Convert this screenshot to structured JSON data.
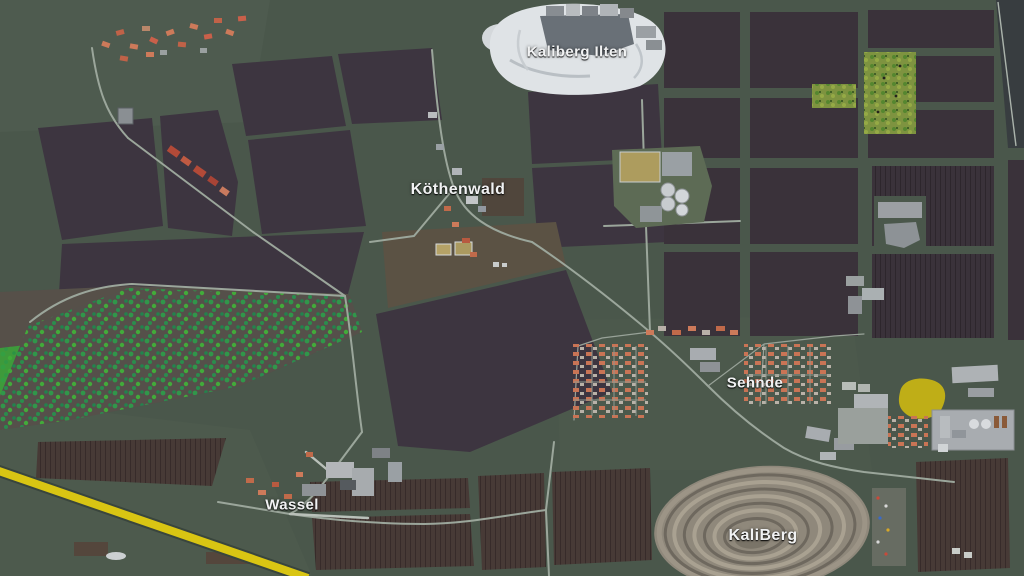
{
  "map": {
    "labels": [
      {
        "id": "kaliberg-ilten",
        "text": "Kaliberg Ilten"
      },
      {
        "id": "koethenwald",
        "text": "Köthenwald"
      },
      {
        "id": "sehnde",
        "text": "Sehnde"
      },
      {
        "id": "wassel",
        "text": "Wassel"
      },
      {
        "id": "kaliberg",
        "text": "KaliBerg"
      }
    ],
    "colors": {
      "terrain": "#4a574b",
      "terrain_light": "#4e5b4f",
      "field_dark": "#3d3540",
      "field_dark2": "#3a323a",
      "field_brown": "#473a36",
      "field_brown2": "#5b5244",
      "road": "#9ba69b",
      "rail_yellow": "#d9c513",
      "salt_white": "#dfe3e6",
      "mine_light": "#a9a191",
      "mine_dark": "#6e685e",
      "roof_orange": "#c97455",
      "building_grey": "#a8acb0",
      "pond_yellow": "#bfae17",
      "tree_green": "#2aa44a",
      "orchard_green": "#7e9340"
    },
    "landmarks": [
      "salt-heap-kaliberg-ilten",
      "village-koethenwald",
      "town-sehnde",
      "village-wassel",
      "open-pit-spiral-kaliberg",
      "biogas-plant",
      "forest-band",
      "orchard-fields",
      "yellow-railway-line",
      "industrial-area-east",
      "yellow-pond",
      "scattered-village-northwest"
    ]
  }
}
